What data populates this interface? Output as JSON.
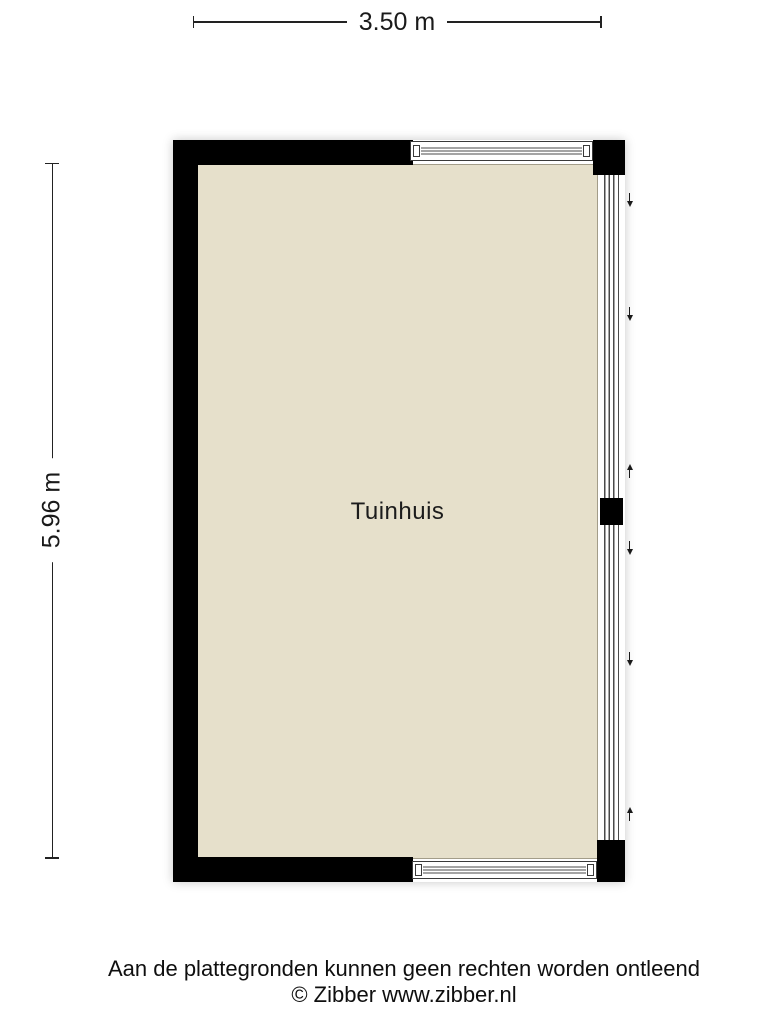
{
  "dimensions": {
    "width_label": "3.50 m",
    "height_label": "5.96 m"
  },
  "room": {
    "label": "Tuinhuis"
  },
  "footer": {
    "disclaimer": "Aan de plattegronden kunnen geen rechten worden ontleend",
    "copyright": "© Zibber www.zibber.nl"
  },
  "colors": {
    "wall": "#000000",
    "floor": "#e6e0cb",
    "floor_border": "#a39d89",
    "window_frame": "#3a3a3a",
    "dimension_line": "#222222",
    "background": "#ffffff"
  },
  "floorplan": {
    "right_wall_arrows": [
      {
        "direction": "down",
        "y": 192
      },
      {
        "direction": "down",
        "y": 306
      },
      {
        "direction": "up",
        "y": 465
      },
      {
        "direction": "down",
        "y": 540
      },
      {
        "direction": "down",
        "y": 651
      },
      {
        "direction": "up",
        "y": 808
      }
    ]
  }
}
